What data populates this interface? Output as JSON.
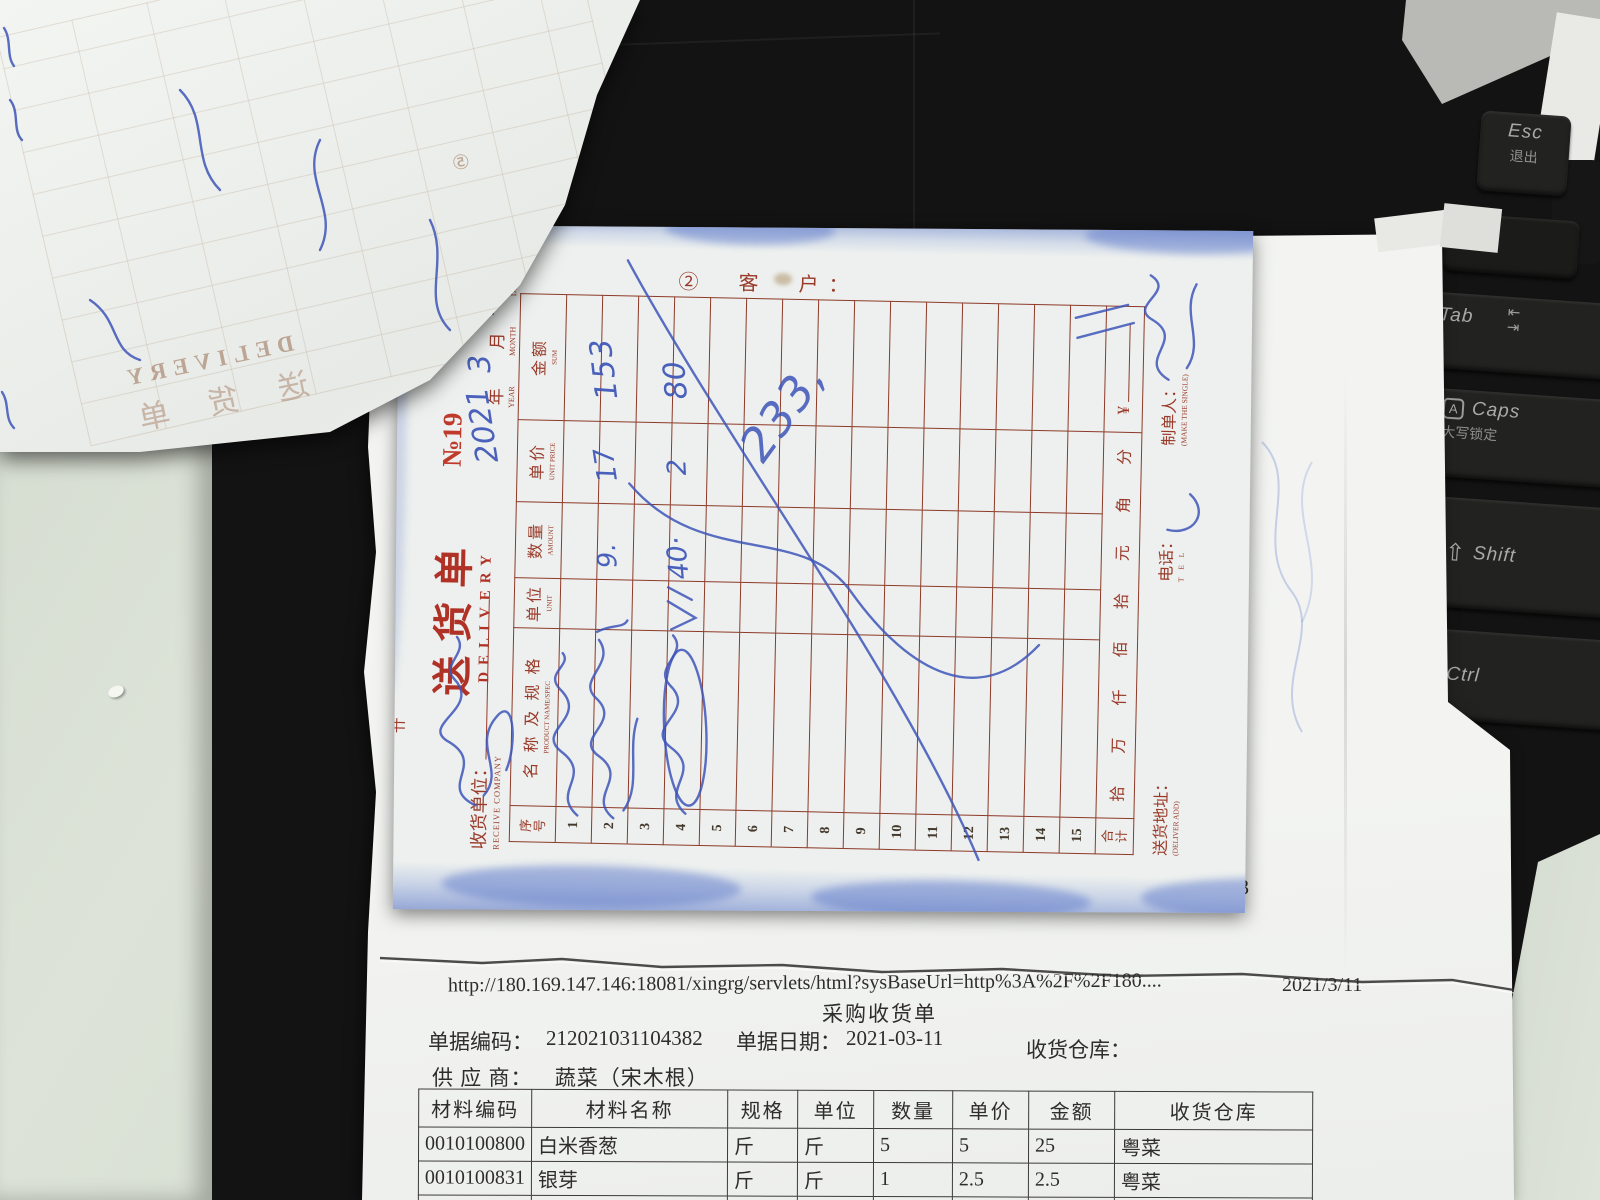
{
  "colors": {
    "form_red": "#9a3a2a",
    "ink_blue": "#3d55b8",
    "stain_blue": "#6d8fd4"
  },
  "keyboard": {
    "keys": [
      {
        "id": "esc",
        "label": "Esc",
        "sub": "退出"
      },
      {
        "id": "tab",
        "label": "Tab",
        "sub": ""
      },
      {
        "id": "caps",
        "label": "Caps",
        "sub": "大写锁定"
      },
      {
        "id": "shift",
        "label": "Shift",
        "sub": ""
      },
      {
        "id": "ctrl",
        "label": "Ctrl",
        "sub": ""
      }
    ]
  },
  "ghost_page": {
    "subtitle_mirrored": "DELIVERY",
    "title_mirrored": "送 货 单",
    "copy_badge": "⑤"
  },
  "delivery_form": {
    "title": "送货单",
    "title_en": "DELIVERY",
    "number": "№19",
    "copy_badge_and_customer": "②　客　户：",
    "receive_company_label": "收货单位：",
    "receive_company_en": "RECEIVE COMPANY",
    "stub_mark": "卄",
    "date": {
      "year_label": "年",
      "year_en": "YEAR",
      "year_value": "2021",
      "month_label": "月",
      "month_en": "MONTH",
      "month_value": "3",
      "day_label": "日",
      "day_en": "DAY",
      "day_value": "11"
    },
    "columns": [
      {
        "zh": "序号",
        "en": ""
      },
      {
        "zh": "名 称 及 规 格",
        "en": "PRODUCT NAME/SPEC"
      },
      {
        "zh": "单位",
        "en": "UNIT"
      },
      {
        "zh": "数量",
        "en": "AMOUNT"
      },
      {
        "zh": "单价",
        "en": "UNIT PRICE"
      },
      {
        "zh": "金额",
        "en": "SUM"
      }
    ],
    "row_count": 15,
    "rows": {
      "2": {
        "qty": "9.",
        "price": "17",
        "sum": "153"
      },
      "4": {
        "qty": "40·",
        "price": "2",
        "sum": "80"
      }
    },
    "big_scrawl": "233,",
    "total_row": {
      "label": "合计",
      "digits": "拾 万 仟 佰 拾 元 角 分",
      "currency": "¥"
    },
    "footer": {
      "address_label": "送货地址：",
      "address_en": "(DELIVER ADD)",
      "tel_label": "电话：",
      "tel_en": "T E L",
      "maker_label": "制单人：",
      "maker_en": "(MAKE THE SINGLE)"
    }
  },
  "receipt_strip": {
    "maker_label": "制单人：",
    "maker_value": "林响",
    "checker_label": "审核人：",
    "supervisor_label": "主管签名：",
    "total_label": "总金额：",
    "total_value": "808.3"
  },
  "purchase_page": {
    "url": "http://180.169.147.146:18081/xingrg/servlets/html?sysBaseUrl=http%3A%2F%2F180....",
    "print_date": "2021/3/11",
    "title": "采购收货单",
    "doc_code_label": "单据编码：",
    "doc_code": "212021031104382",
    "doc_date_label": "单据日期：",
    "doc_date": "2021-03-11",
    "warehouse_label": "收货仓库：",
    "supplier_label": "供 应 商：",
    "supplier": "蔬菜（宋木根）",
    "table": {
      "headers": [
        "材料编码",
        "材料名称",
        "规格",
        "单位",
        "数量",
        "单价",
        "金额",
        "收货仓库"
      ],
      "rows": [
        [
          "0010100800",
          "白米香葱",
          "斤",
          "斤",
          "5",
          "5",
          "25",
          "粤菜"
        ],
        [
          "0010100831",
          "银芽",
          "斤",
          "斤",
          "1",
          "2.5",
          "2.5",
          "粤菜"
        ],
        [
          "0010100809",
          "红萝卜",
          "斤",
          "斤",
          "",
          "",
          "",
          ""
        ]
      ]
    }
  }
}
